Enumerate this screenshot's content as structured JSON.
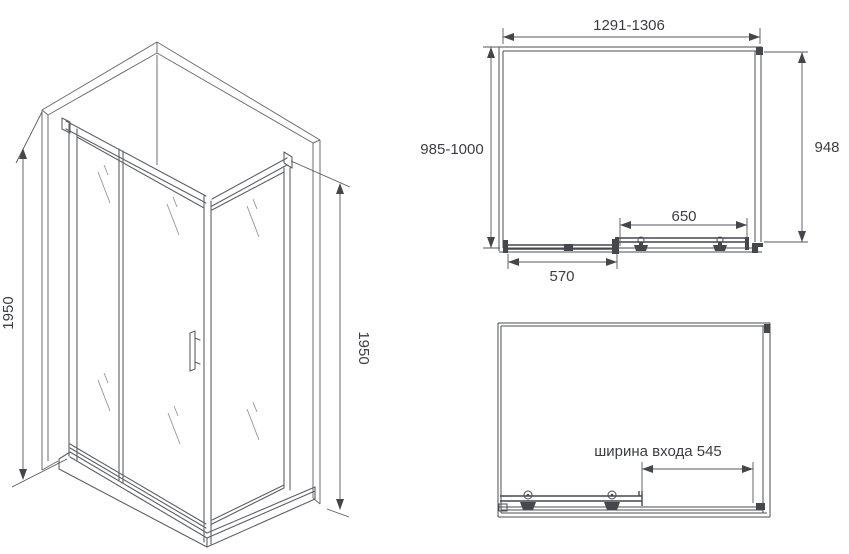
{
  "colors": {
    "background": "#ffffff",
    "line": "#55575a",
    "text": "#3c3e42"
  },
  "iso_view": {
    "height_left": "1950",
    "height_right": "1950"
  },
  "plan_view": {
    "width_range": "1291-1306",
    "depth_range": "985-1000",
    "side_depth": "948",
    "door_width": "650",
    "fixed_panel_width": "570"
  },
  "open_view": {
    "entrance_width_label": "ширина входа 545"
  }
}
